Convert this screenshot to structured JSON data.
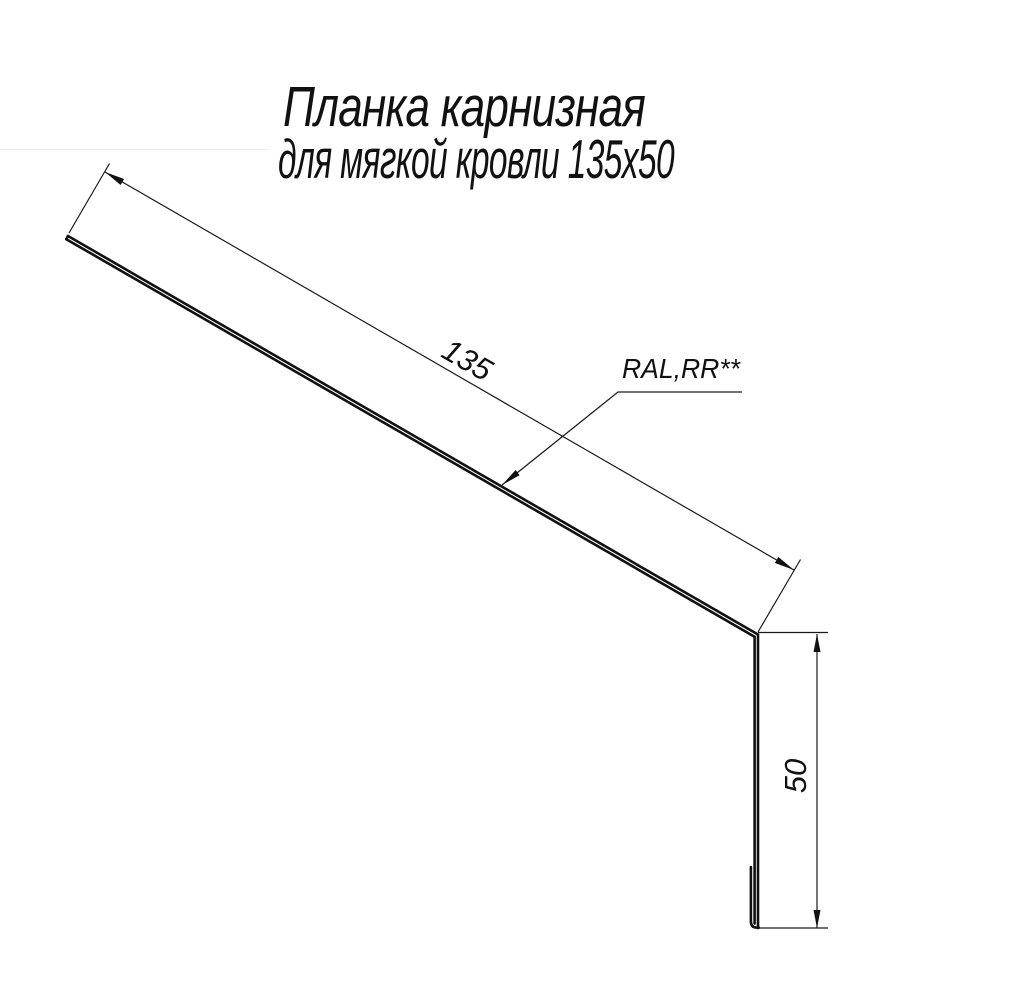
{
  "drawing": {
    "title_line1": "Планка карнизная",
    "title_line2": "для мягкой кровли 135х50",
    "dimensions": {
      "length_label": "135",
      "height_label": "50"
    },
    "leader_label": "RAL,RR**",
    "colors": {
      "line": "#111111",
      "background": "#ffffff"
    }
  }
}
